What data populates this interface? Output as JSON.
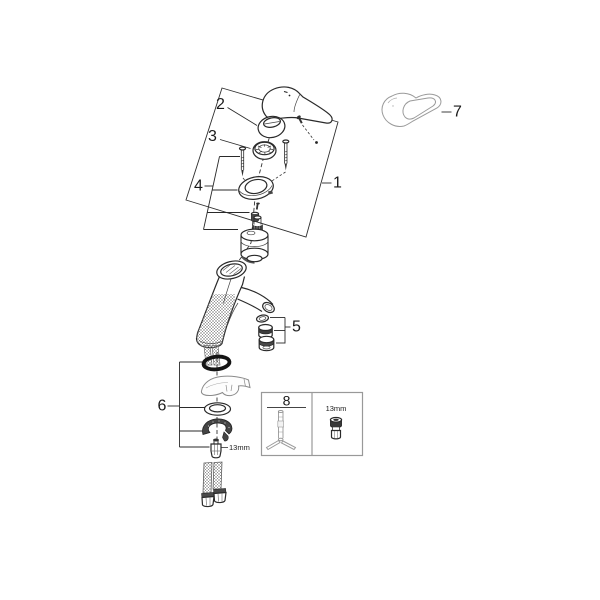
{
  "diagram": {
    "callouts": {
      "c1": "1",
      "c2": "2",
      "c3": "3",
      "c4": "4",
      "c5": "5",
      "c6": "6",
      "c7": "7",
      "c8": "8"
    },
    "labels": {
      "hardware_nut_size": "13mm",
      "tool_socket_size": "13mm"
    },
    "parts": [
      {
        "callout": "1",
        "part": "faucet-top-assembly"
      },
      {
        "callout": "2",
        "part": "handle-cap"
      },
      {
        "callout": "3",
        "part": "cartridge-ring"
      },
      {
        "callout": "4",
        "part": "cartridge-mounting-set"
      },
      {
        "callout": "5",
        "part": "aerator-set"
      },
      {
        "callout": "6",
        "part": "fastening-set"
      },
      {
        "callout": "7",
        "part": "lever-handle"
      },
      {
        "callout": "8",
        "part": "mounting-tool"
      }
    ],
    "colors": {
      "line": "#222222",
      "light_line": "#9a9a9a",
      "dark_fill": "#3f3f3f",
      "background": "#ffffff",
      "box_border": "#999999"
    }
  }
}
